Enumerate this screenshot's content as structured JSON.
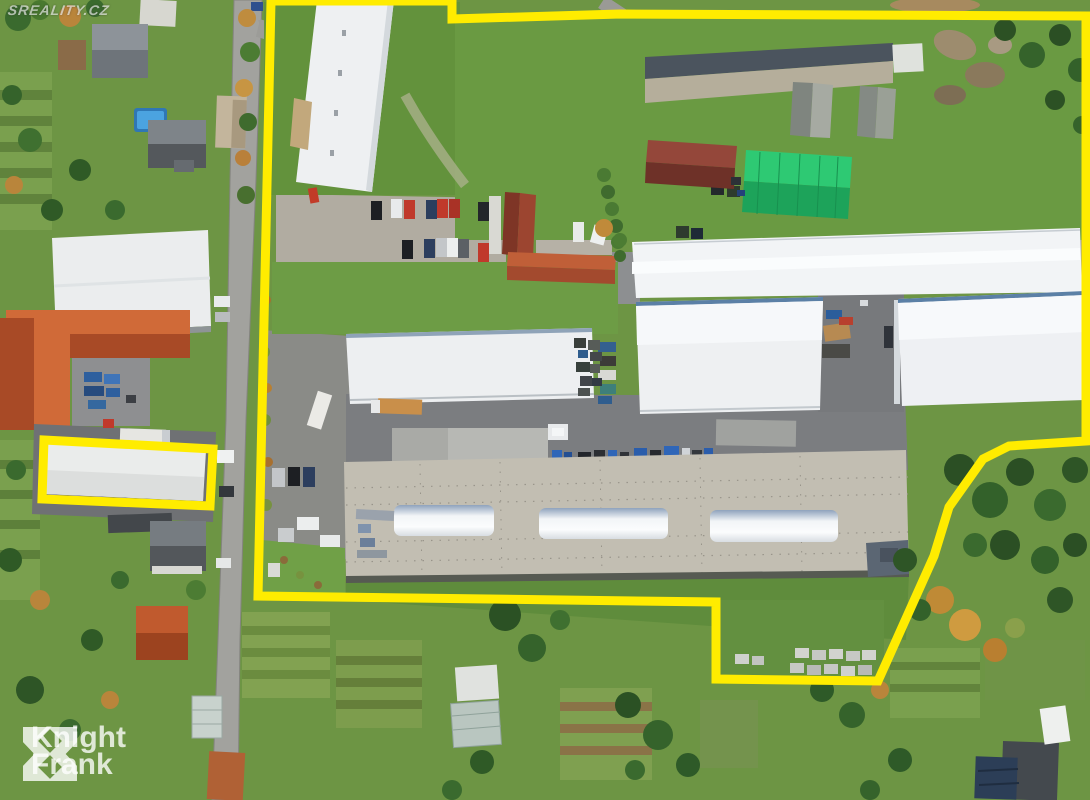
{
  "watermark": {
    "text": "Sreality.cz"
  },
  "logo": {
    "line1": "Knight",
    "line2": "Frank"
  },
  "colors": {
    "boundary_yellow": "#ffec00",
    "logo_white": "rgba(255,255,255,0.78)"
  }
}
